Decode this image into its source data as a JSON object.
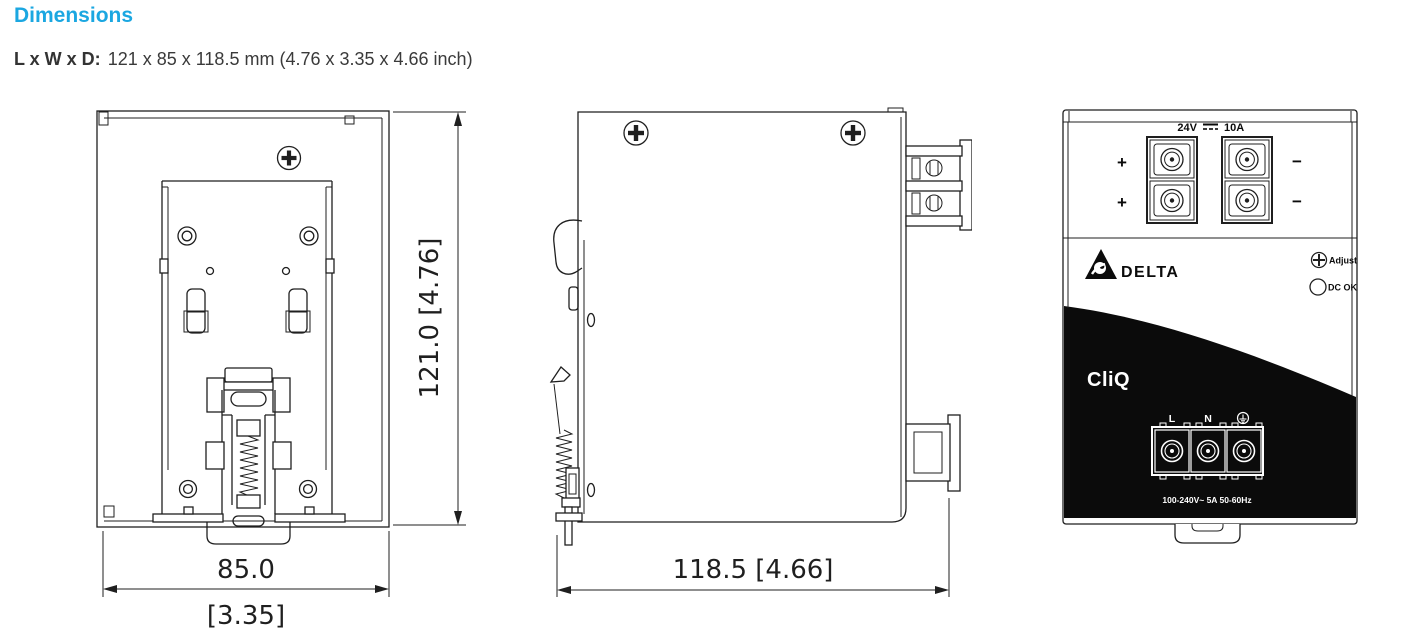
{
  "page": {
    "title": "Dimensions",
    "size_label": "L x W x D:",
    "size_value": "121 x 85 x 118.5 mm (4.76 x 3.35 x 4.66 inch)"
  },
  "colors": {
    "accent": "#1ba7e1",
    "line": "#1f1f1f",
    "panel_black": "#0b0b0b"
  },
  "views": {
    "back": {
      "height_dim": "121.0  [4.76]",
      "width_dim_mm": "85.0",
      "width_dim_in": "[3.35]"
    },
    "side": {
      "depth_dim": "118.5  [4.66]"
    },
    "front": {
      "output_rating": {
        "voltage": "24V",
        "current": "10A",
        "symbol_icon": "dc-symbol-icon"
      },
      "polarity": {
        "plus": "+",
        "minus": "−"
      },
      "brand": "DELTA",
      "series": "CliQ",
      "adjust_label": "Adjust",
      "dc_ok_label": "DC OK",
      "input_terminals": {
        "line": "L",
        "neutral": "N",
        "earth_icon": "earth-ground-icon"
      },
      "input_rating": "100-240V~ 5A 50-60Hz"
    }
  },
  "icons": {
    "screws": "phillips-screw-icon",
    "adjust": "adjust-potentiometer-icon",
    "dc_ok": "dc-ok-led-icon",
    "earth": "earth-ground-icon",
    "dc": "dc-symbol-icon"
  }
}
